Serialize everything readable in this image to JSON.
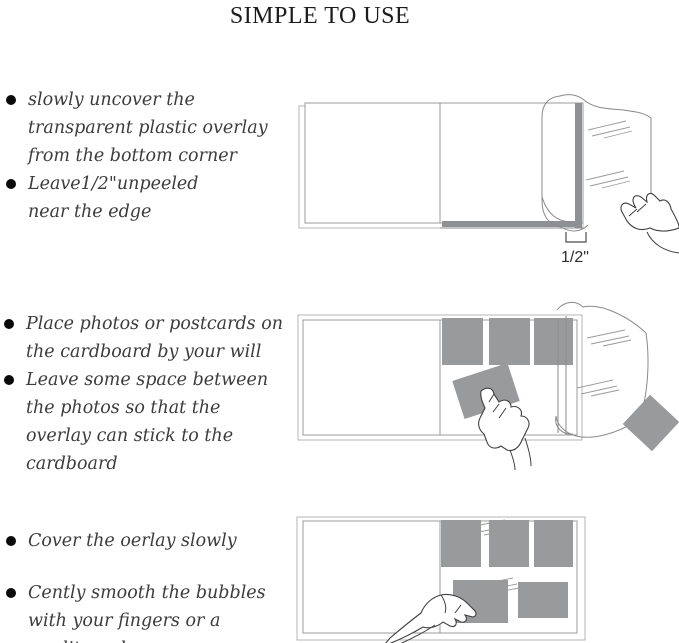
{
  "title": "SIMPLE TO USE",
  "steps": [
    {
      "bullets": [
        "slowly uncover the transparent plastic overlay from the bottom corner",
        "Leave1/2\"unpeeled near the edge"
      ],
      "measurement_label": "1/2\""
    },
    {
      "bullets": [
        "Place photos or postcards on the cardboard by your will",
        "Leave some space between the photos so that the overlay can stick to the cardboard"
      ]
    },
    {
      "bullets": [
        "Cover the oerlay slowly",
        "Cently smooth the bubbles with your fingers or a credit card"
      ]
    }
  ],
  "colors": {
    "photo_gray": "#999a9c",
    "strip_gray": "#8e9094",
    "outline_gray": "#9b9b9b",
    "hand_line": "#3f3f3f",
    "text_color": "#3c3c3c",
    "title_color": "#1b1b1b"
  }
}
